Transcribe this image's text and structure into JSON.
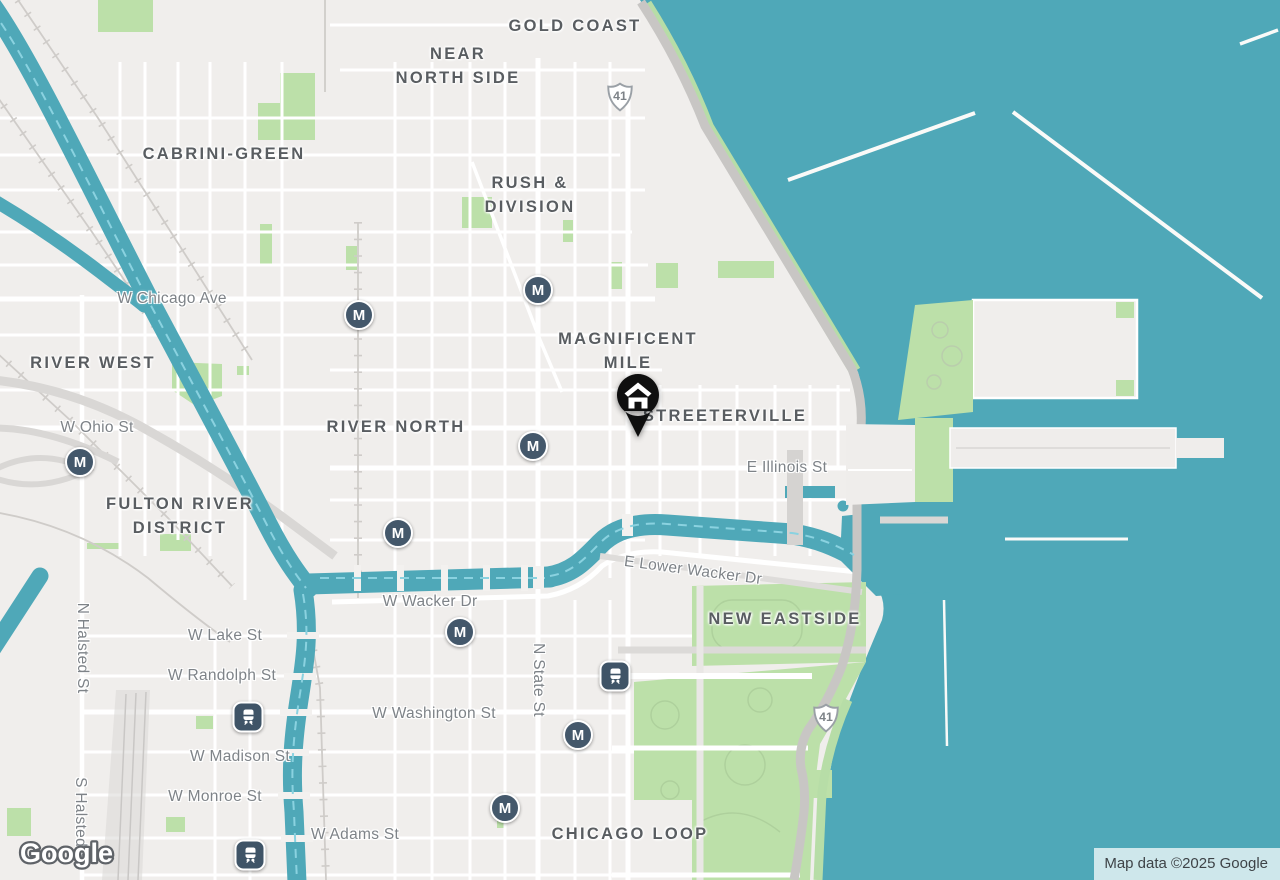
{
  "map": {
    "watermark": "Google",
    "attribution": "Map data ©2025 Google",
    "metro_label": "M",
    "highway": {
      "label": "41"
    },
    "marker": {
      "type": "lodging-home-pin"
    },
    "neighborhoods": [
      {
        "id": "gold-coast",
        "label": "GOLD COAST"
      },
      {
        "id": "near-north-side",
        "label": "NEAR\nNORTH SIDE"
      },
      {
        "id": "cabrini-green",
        "label": "CABRINI-GREEN"
      },
      {
        "id": "rush-division",
        "label": "RUSH &\nDIVISION"
      },
      {
        "id": "magnificent-mile",
        "label": "MAGNIFICENT\nMILE"
      },
      {
        "id": "river-west",
        "label": "RIVER WEST"
      },
      {
        "id": "river-north",
        "label": "RIVER NORTH"
      },
      {
        "id": "streeterville",
        "label": "STREETERVILLE"
      },
      {
        "id": "fulton-river-district",
        "label": "FULTON RIVER\nDISTRICT"
      },
      {
        "id": "new-eastside",
        "label": "NEW EASTSIDE"
      },
      {
        "id": "chicago-loop",
        "label": "CHICAGO LOOP"
      }
    ],
    "streets": [
      {
        "id": "w-chicago-ave",
        "label": "W Chicago Ave"
      },
      {
        "id": "w-ohio-st",
        "label": "W Ohio St"
      },
      {
        "id": "e-illinois-st",
        "label": "E Illinois St"
      },
      {
        "id": "e-lower-wacker-dr",
        "label": "E Lower Wacker Dr"
      },
      {
        "id": "w-wacker-dr",
        "label": "W Wacker Dr"
      },
      {
        "id": "w-lake-st",
        "label": "W Lake St"
      },
      {
        "id": "w-randolph-st",
        "label": "W Randolph St"
      },
      {
        "id": "w-washington-st",
        "label": "W Washington St"
      },
      {
        "id": "w-madison-st",
        "label": "W Madison St"
      },
      {
        "id": "w-monroe-st",
        "label": "W Monroe St"
      },
      {
        "id": "w-adams-st",
        "label": "W Adams St"
      },
      {
        "id": "n-halsted-st",
        "label": "N Halsted St"
      },
      {
        "id": "s-halsted-st",
        "label": "S Halsted St"
      },
      {
        "id": "n-state-st",
        "label": "N State St"
      }
    ],
    "colors": {
      "water": "#4FA8B8",
      "land": "#F0EEEC",
      "park": "#BCE0A9",
      "road": "#FFFFFF",
      "major_road": "#C8C6C4",
      "railway": "#CFCCC9",
      "neighborhood_label": "#595D61",
      "street_label": "#7E8388",
      "transit_badge": "#44586B",
      "marker": "#0F0F0F"
    }
  }
}
